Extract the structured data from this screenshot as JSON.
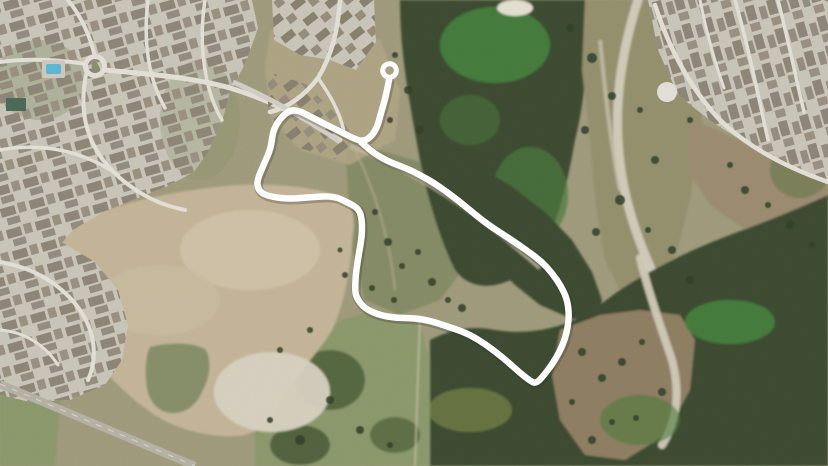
{
  "image": {
    "width": 828,
    "height": 466,
    "kind": "aerial satellite photograph",
    "overlay": "hand-drawn white route loop with circular start marker",
    "visible_text": ""
  },
  "palette": {
    "route": "#ffffff",
    "route_shadow": "rgba(50,50,40,0.28)",
    "scrub_base": "#a19c7e",
    "olive_field": "#868c66",
    "green_field": "#8c9a6d",
    "scrub_right": "#95916e",
    "forest_dark": "#3c4c31",
    "forest_darker": "#31402a",
    "bright_green": "#478540",
    "bright_green2": "#4c7c3e",
    "dirt": "#c5b69a",
    "dirt_light": "#d2c5ab",
    "dirt_pale": "#d9d3c3",
    "pond": "#87906a",
    "residential": "#cac6ba",
    "street": "#e3e0d8",
    "roof": "#8e8678",
    "road": "#b6b2a5",
    "creek_sand": "#d7d2c2",
    "field_brown": "#9c8c72",
    "field_brown_br": "#8f7f63",
    "pool_blue": "#5cb8d2",
    "court_green": "#4a6a58",
    "lawn": "#7e8e60"
  },
  "route": {
    "color": "#ffffff",
    "width": 6.5,
    "shadow_width": 9,
    "points": [
      [
        389,
        80
      ],
      [
        386,
        96
      ],
      [
        381,
        113
      ],
      [
        377,
        128
      ],
      [
        370,
        138
      ],
      [
        361,
        142
      ],
      [
        341,
        132
      ],
      [
        317,
        120
      ],
      [
        294,
        108
      ],
      [
        282,
        116
      ],
      [
        273,
        130
      ],
      [
        271,
        148
      ],
      [
        264,
        164
      ],
      [
        258,
        178
      ],
      [
        257,
        186
      ],
      [
        261,
        193
      ],
      [
        272,
        197
      ],
      [
        290,
        199
      ],
      [
        312,
        197
      ],
      [
        334,
        196
      ],
      [
        349,
        203
      ],
      [
        359,
        209
      ],
      [
        362,
        220
      ],
      [
        362,
        236
      ],
      [
        359,
        253
      ],
      [
        356,
        272
      ],
      [
        355,
        288
      ],
      [
        356,
        297
      ],
      [
        364,
        308
      ],
      [
        379,
        315
      ],
      [
        396,
        318
      ],
      [
        414,
        318
      ],
      [
        431,
        321
      ],
      [
        446,
        326
      ],
      [
        461,
        331
      ],
      [
        472,
        336
      ],
      [
        485,
        344
      ],
      [
        497,
        353
      ],
      [
        508,
        362
      ],
      [
        519,
        372
      ],
      [
        529,
        380
      ],
      [
        536,
        384
      ],
      [
        545,
        374
      ],
      [
        553,
        363
      ],
      [
        560,
        351
      ],
      [
        565,
        339
      ],
      [
        568,
        326
      ],
      [
        569,
        313
      ],
      [
        567,
        299
      ],
      [
        561,
        286
      ],
      [
        552,
        273
      ],
      [
        542,
        262
      ],
      [
        529,
        252
      ],
      [
        516,
        243
      ],
      [
        504,
        235
      ],
      [
        493,
        228
      ],
      [
        482,
        220
      ],
      [
        471,
        211
      ],
      [
        460,
        202
      ],
      [
        447,
        192
      ],
      [
        434,
        183
      ],
      [
        420,
        175
      ],
      [
        406,
        168
      ],
      [
        392,
        163
      ],
      [
        380,
        157
      ],
      [
        370,
        150
      ],
      [
        361,
        142
      ]
    ],
    "start_marker": {
      "cx": 389.5,
      "cy": 70.5,
      "r": 6.8,
      "ring_width": 5.0
    }
  },
  "vegetation_dots": [
    [
      375,
      212,
      3
    ],
    [
      388,
      242,
      4
    ],
    [
      402,
      266,
      3
    ],
    [
      418,
      252,
      3
    ],
    [
      432,
      282,
      4
    ],
    [
      448,
      300,
      3
    ],
    [
      462,
      308,
      4
    ],
    [
      372,
      288,
      3
    ],
    [
      394,
      300,
      3
    ],
    [
      340,
      250,
      2.5
    ],
    [
      345,
      275,
      3
    ],
    [
      592,
      58,
      5
    ],
    [
      612,
      96,
      4
    ],
    [
      585,
      130,
      4
    ],
    [
      640,
      110,
      3
    ],
    [
      655,
      160,
      4
    ],
    [
      620,
      200,
      5
    ],
    [
      596,
      232,
      4
    ],
    [
      648,
      230,
      3
    ],
    [
      672,
      250,
      4
    ],
    [
      690,
      120,
      3
    ],
    [
      700,
      60,
      4
    ],
    [
      570,
      28,
      4
    ],
    [
      690,
      280,
      4
    ],
    [
      745,
      190,
      4
    ],
    [
      768,
      205,
      3
    ],
    [
      790,
      225,
      4
    ],
    [
      812,
      245,
      3
    ],
    [
      730,
      165,
      3
    ],
    [
      582,
      352,
      4
    ],
    [
      602,
      378,
      4
    ],
    [
      572,
      402,
      3
    ],
    [
      622,
      362,
      4
    ],
    [
      642,
      342,
      3
    ],
    [
      662,
      392,
      4
    ],
    [
      612,
      422,
      3
    ],
    [
      592,
      440,
      4
    ],
    [
      636,
      418,
      3
    ],
    [
      395,
      55,
      3
    ],
    [
      408,
      90,
      4
    ],
    [
      390,
      120,
      3
    ],
    [
      420,
      130,
      4
    ],
    [
      310,
      330,
      3
    ],
    [
      280,
      350,
      3
    ],
    [
      300,
      440,
      5
    ],
    [
      330,
      400,
      4
    ],
    [
      360,
      430,
      4
    ],
    [
      390,
      445,
      3
    ],
    [
      270,
      420,
      3
    ]
  ],
  "regions": [
    {
      "name": "residential-northwest",
      "type": "suburban houses"
    },
    {
      "name": "residential-northeast",
      "type": "suburban houses"
    },
    {
      "name": "residential-top-cluster",
      "type": "houses under construction"
    },
    {
      "name": "cleared-dirt-area",
      "type": "graded development land"
    },
    {
      "name": "retention-pond",
      "type": "water"
    },
    {
      "name": "forest-top",
      "type": "woodland"
    },
    {
      "name": "forest-bottom-right",
      "type": "woodland"
    },
    {
      "name": "scrub-right",
      "type": "scrub with sandy creek"
    },
    {
      "name": "fields",
      "type": "open grass fields"
    },
    {
      "name": "roads",
      "type": "paved roads"
    }
  ]
}
